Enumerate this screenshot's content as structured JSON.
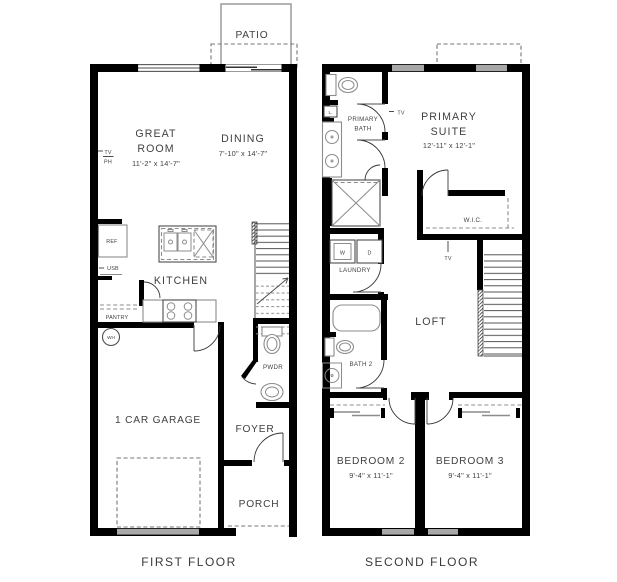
{
  "palette": {
    "background": "#ffffff",
    "wall": "#000000",
    "window_gray": "#a8a8a8",
    "fixture_gray": "#8c8c8c",
    "label_text": "#414141"
  },
  "first_floor": {
    "caption": "FIRST FLOOR",
    "patio": {
      "label": "PATIO"
    },
    "great_room": {
      "line1": "GREAT",
      "line2": "ROOM",
      "dims": "11'-2\" x 14'-7\""
    },
    "dining": {
      "label": "DINING",
      "dims": "7'-10\" x 14'-7\""
    },
    "wall_tags": {
      "tv": "TV",
      "ph": "PH"
    },
    "kitchen": {
      "label": "KITCHEN",
      "ref": "REF",
      "usb": "USB",
      "pantry": "PANTRY"
    },
    "water_heater": "WH",
    "pwdr": "PWDR",
    "garage": "1 CAR GARAGE",
    "foyer": "FOYER",
    "porch": "PORCH"
  },
  "second_floor": {
    "caption": "SECOND FLOOR",
    "primary_bath": {
      "line1": "PRIMARY",
      "line2": "BATH",
      "linen": "L.",
      "tv_tag": "TV"
    },
    "primary_suite": {
      "line1": "PRIMARY",
      "line2": "SUITE",
      "dims": "12'-11\" x 12'-1\""
    },
    "wic": {
      "label": "W.I.C."
    },
    "laundry": {
      "label": "LAUNDRY",
      "washer": "W",
      "dryer": "D"
    },
    "loft": {
      "label": "LOFT",
      "tv_tag": "TV"
    },
    "bath2": {
      "label": "BATH 2"
    },
    "bedroom2": {
      "label": "BEDROOM 2",
      "dims": "9'-4\" x 11'-1\""
    },
    "bedroom3": {
      "label": "BEDROOM 3",
      "dims": "9'-4\" x 11'-1\""
    }
  }
}
